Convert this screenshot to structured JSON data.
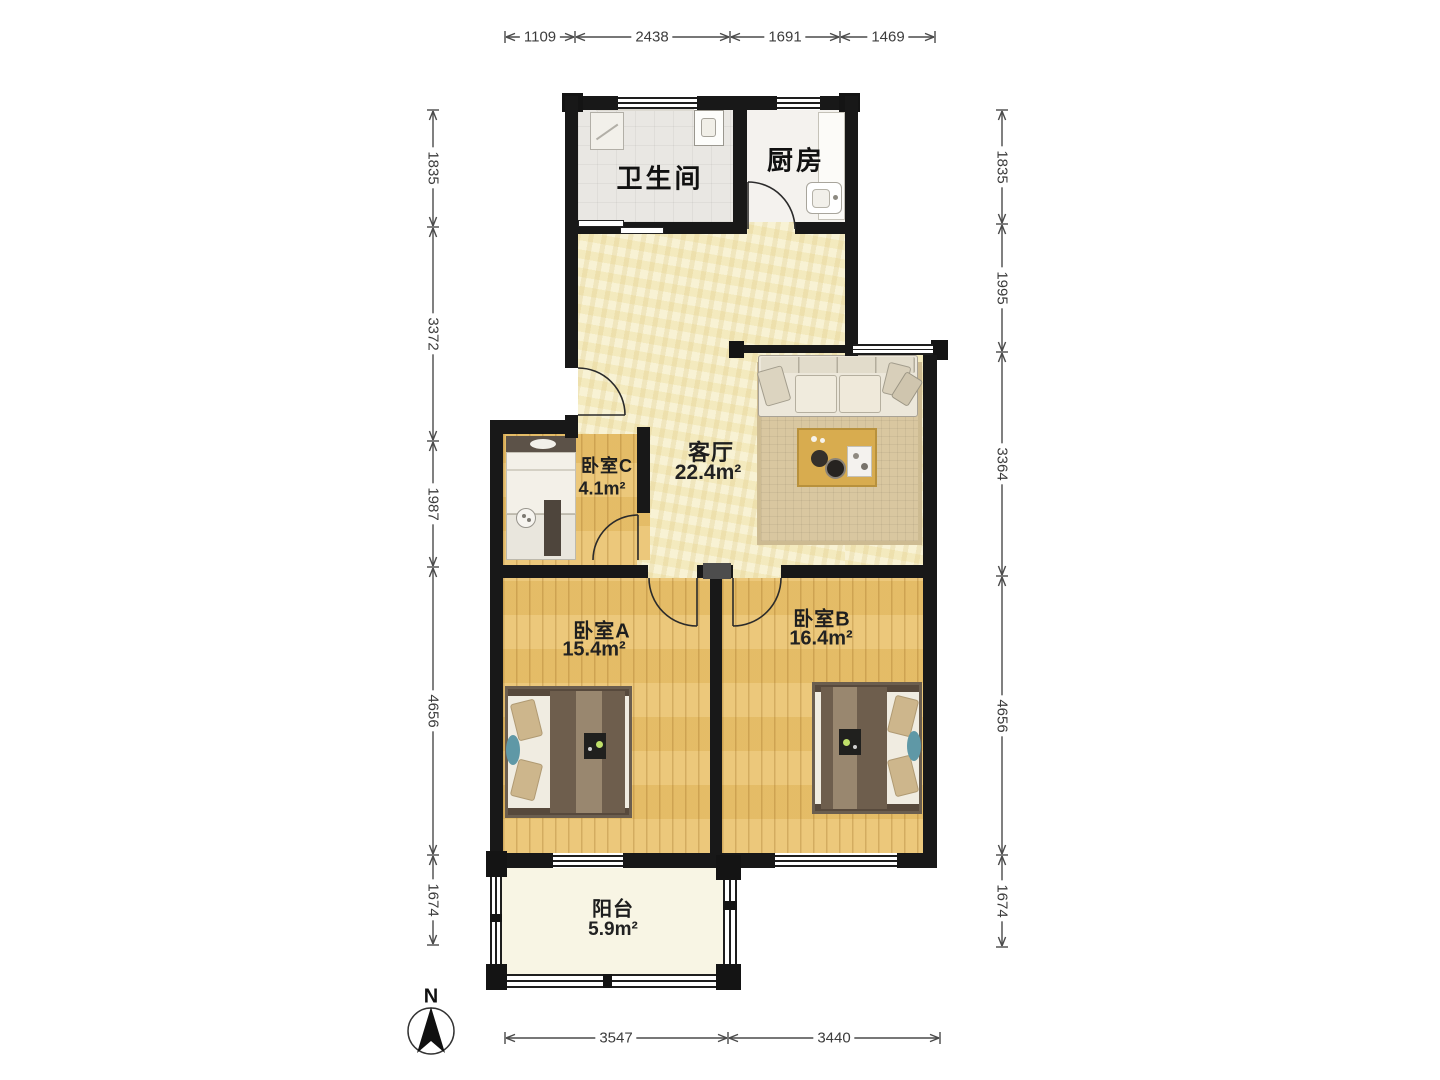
{
  "title": "两室两厅户型图",
  "compass": {
    "label": "N"
  },
  "rooms": {
    "bathroom": {
      "name": "卫生间"
    },
    "kitchen": {
      "name": "厨房"
    },
    "living": {
      "name": "客厅",
      "area": "22.4m²"
    },
    "bedroomC": {
      "name": "卧室C",
      "area": "4.1m²"
    },
    "bedroomA": {
      "name": "卧室A",
      "area": "15.4m²"
    },
    "bedroomB": {
      "name": "卧室B",
      "area": "16.4m²"
    },
    "balcony": {
      "name": "阳台",
      "area": "5.9m²"
    }
  },
  "dimensions_mm": {
    "top": [
      "1109",
      "2438",
      "1691",
      "1469"
    ],
    "left": [
      "1835",
      "3372",
      "1987",
      "4656",
      "1674"
    ],
    "right": [
      "1835",
      "1995",
      "3364",
      "4656",
      "1674"
    ],
    "bottom": [
      "3547",
      "3440"
    ]
  },
  "colors": {
    "wall": "#181818",
    "living_floor": "#f5edc5",
    "wood_floor": "#eac26c",
    "bath_floor": "#e9e7e3",
    "balcony_floor": "#f8f5e4",
    "accent_teal": "#5f98a6",
    "table_wood": "#d8ac4f"
  }
}
